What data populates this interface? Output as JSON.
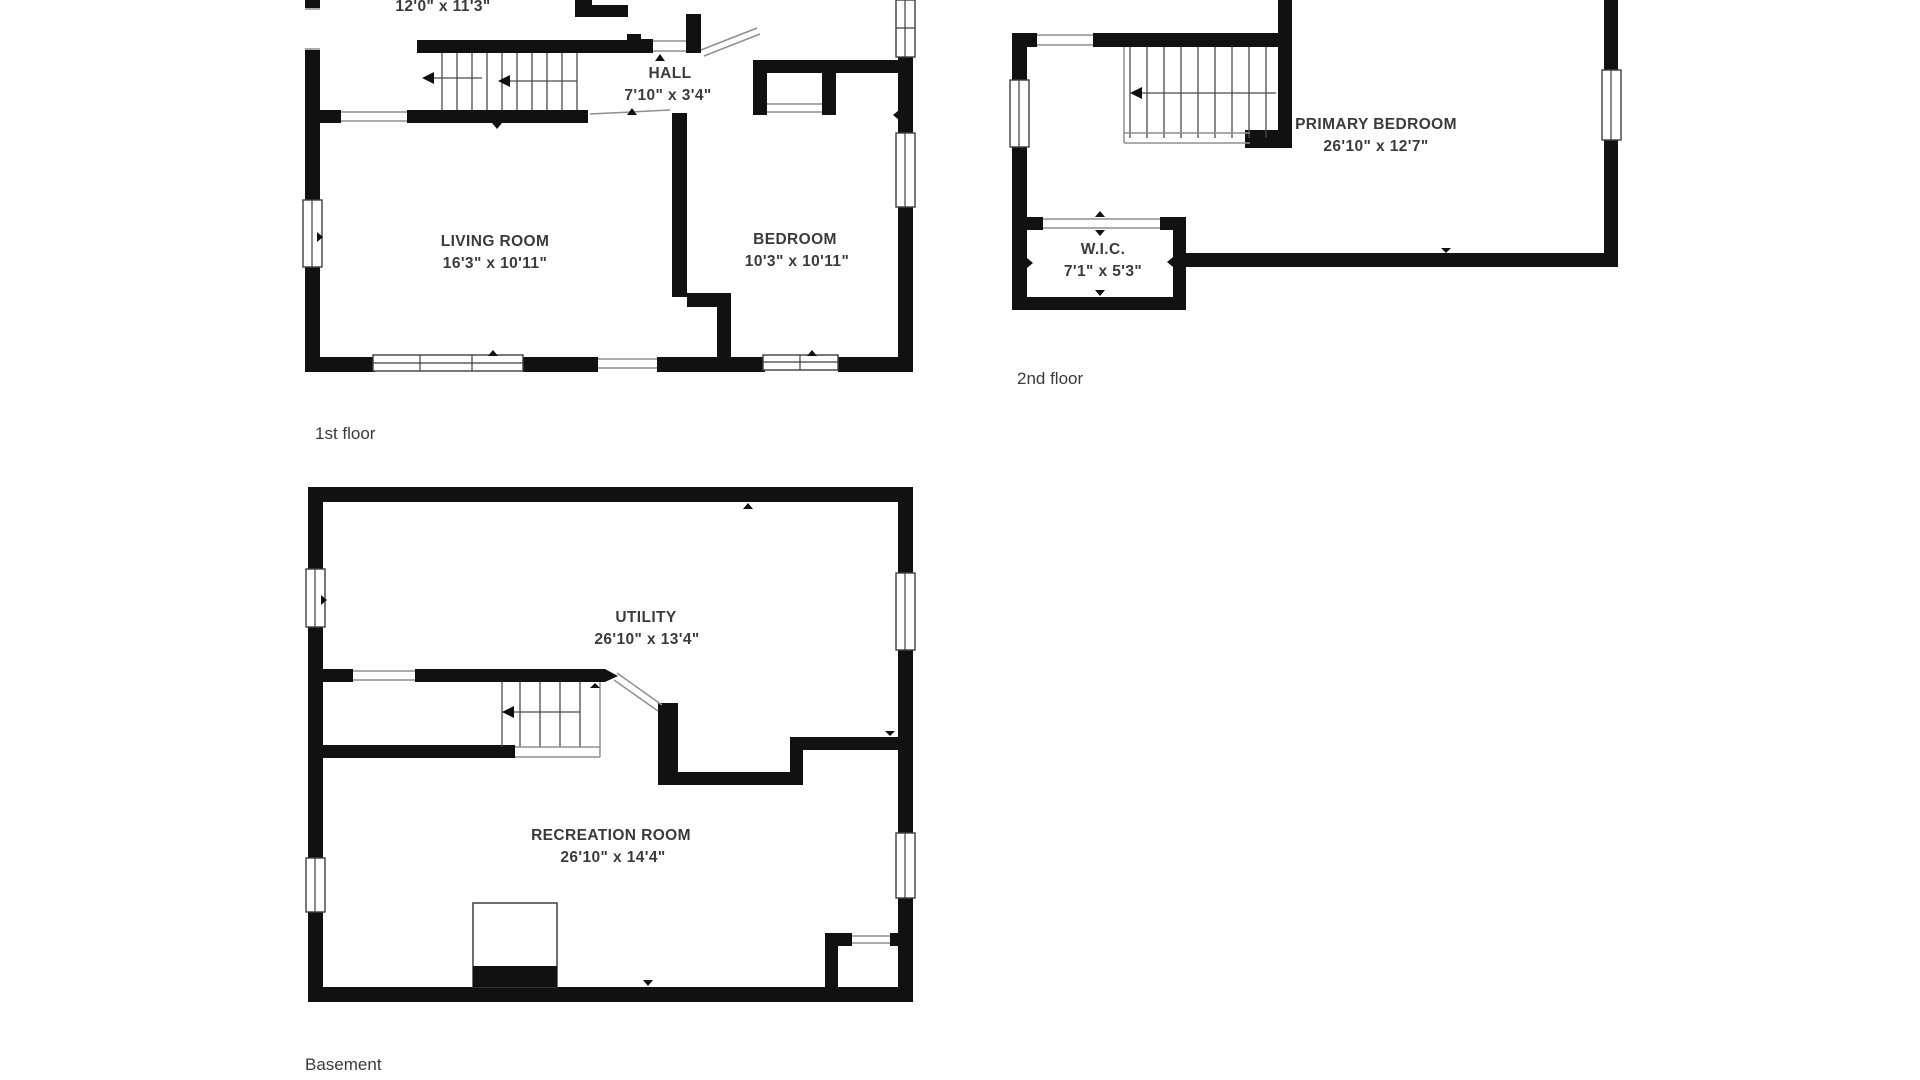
{
  "document": {
    "type": "floor-plan-sheet",
    "background": "#ffffff"
  },
  "colors": {
    "wall": "#111111",
    "text": "#3b3b3b",
    "thin_line": "#8f8f8f"
  },
  "floors": {
    "first": {
      "label": "1st floor",
      "rooms": {
        "top_room": {
          "dims": "12'0\" x 11'3\""
        },
        "hall": {
          "name": "HALL",
          "dims": "7'10\" x 3'4\""
        },
        "living": {
          "name": "LIVING ROOM",
          "dims": "16'3\" x 10'11\""
        },
        "bedroom": {
          "name": "BEDROOM",
          "dims": "10'3\" x 10'11\""
        }
      }
    },
    "second": {
      "label": "2nd floor",
      "rooms": {
        "primary": {
          "name": "PRIMARY BEDROOM",
          "dims": "26'10\" x 12'7\""
        },
        "wic": {
          "name": "W.I.C.",
          "dims": "7'1\" x 5'3\""
        }
      }
    },
    "basement": {
      "label": "Basement",
      "rooms": {
        "utility": {
          "name": "UTILITY",
          "dims": "26'10\" x 13'4\""
        },
        "recreation": {
          "name": "RECREATION ROOM",
          "dims": "26'10\" x 14'4\""
        }
      }
    }
  }
}
